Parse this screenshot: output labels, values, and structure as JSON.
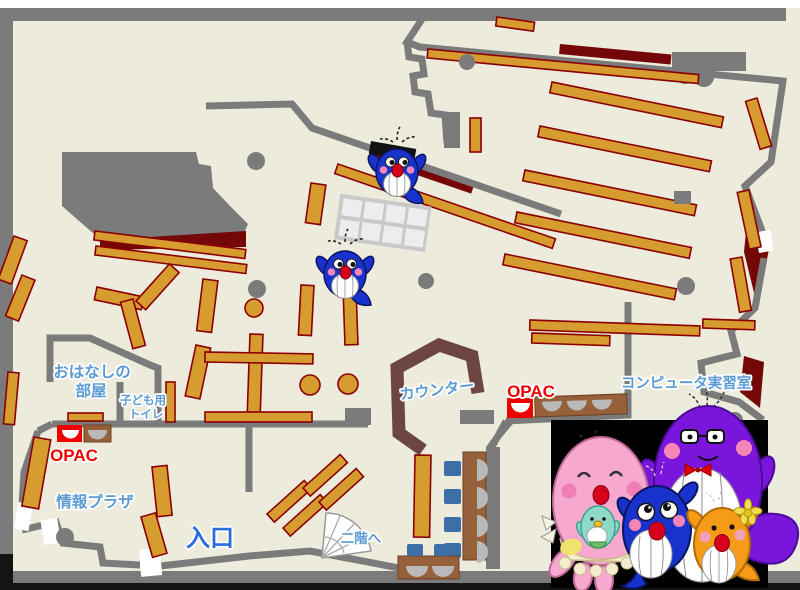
{
  "map": {
    "labels": {
      "storytelling_room": [
        "おはなしの",
        "部屋"
      ],
      "kids_toilet": [
        "子ども用",
        "トイレ"
      ],
      "opac_left": "OPAC",
      "opac_right": "OPAC",
      "info_plaza": "情報プラザ",
      "entrance": "入口",
      "to_second_floor": "二階へ",
      "counter": "カウンター",
      "computer_room": "コンピュータ実習室"
    },
    "colors": {
      "floor": "#EDEBDC",
      "wall_gray": "#7B7B7B",
      "shelf_gold": "#D69C2F",
      "shelf_border_red": "#8B0000",
      "desk_brown": "#96613A",
      "counter_maroon": "#6E4545",
      "accent_dark_red": "#740808",
      "label_blue": "#5B9BD5",
      "entrance_blue": "#2B6BE0",
      "opac_red": "#EE0000",
      "chair_blue": "#3D6FA6"
    },
    "mascots": {
      "on_map": [
        "blue-whale-mascot",
        "blue-whale-mascot"
      ],
      "family_photo": [
        "pink-whale-mother",
        "green-whale-baby",
        "blue-whale-child",
        "purple-whale-father",
        "orange-whale-child"
      ]
    }
  }
}
